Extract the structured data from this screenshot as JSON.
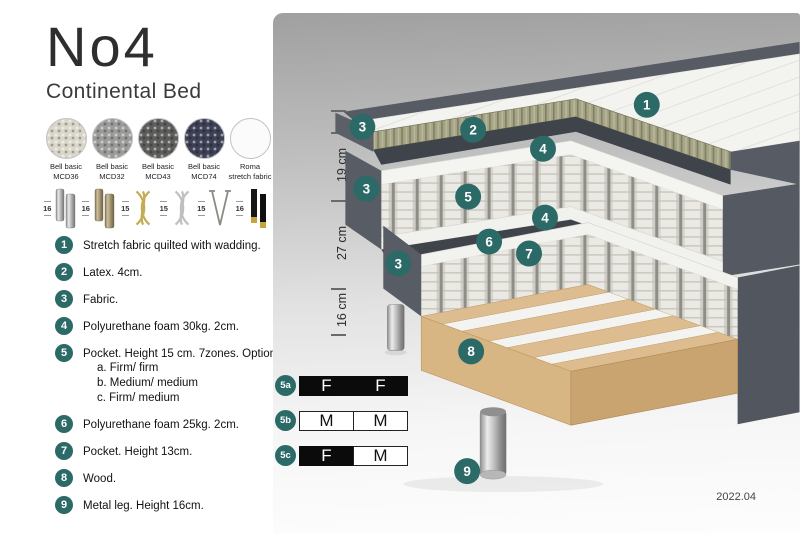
{
  "header": {
    "title": "No4",
    "subtitle": "Continental Bed"
  },
  "swatches": {
    "items": [
      {
        "line1": "Bell basic",
        "line2": "MCD36",
        "color": "#DAD6CA"
      },
      {
        "line1": "Bell basic",
        "line2": "MCD32",
        "color": "#9B9B99"
      },
      {
        "line1": "Bell basic",
        "line2": "MCD43",
        "color": "#5D5D5B"
      },
      {
        "line1": "Bell basic",
        "line2": "MCD74",
        "color": "#3E4156"
      },
      {
        "line1": "Roma",
        "line2": "stretch fabric",
        "color": "#FBFBFB"
      }
    ]
  },
  "legs": {
    "items": [
      {
        "size": "16",
        "name": "chrome-cylinder-leg"
      },
      {
        "size": "16",
        "name": "bronze-cylinder-leg"
      },
      {
        "size": "15",
        "name": "gold-twist-leg"
      },
      {
        "size": "15",
        "name": "silver-twist-leg"
      },
      {
        "size": "15",
        "name": "hairpin-leg"
      },
      {
        "size": "16",
        "name": "black-gold-leg"
      }
    ]
  },
  "features": [
    {
      "num": "1",
      "text": "Stretch fabric quilted with wadding."
    },
    {
      "num": "2",
      "text": "Latex. 4cm."
    },
    {
      "num": "3",
      "text": "Fabric."
    },
    {
      "num": "4",
      "text": "Polyurethane foam 30kg. 2cm."
    },
    {
      "num": "5",
      "text": "Pocket. Height 15 cm. 7zones. Option:",
      "options": [
        "a. Firm/ firm",
        "b. Medium/ medium",
        "c. Firm/ medium"
      ]
    },
    {
      "num": "6",
      "text": "Polyurethane foam 25kg. 2cm."
    },
    {
      "num": "7",
      "text": "Pocket. Height 13cm."
    },
    {
      "num": "8",
      "text": "Wood."
    },
    {
      "num": "9",
      "text": "Metal leg. Height 16cm."
    }
  ],
  "dimensions": [
    "6",
    "19 cm",
    "27 cm",
    "16 cm"
  ],
  "firmness": [
    {
      "label": "5a",
      "cells": [
        {
          "text": "F",
          "variant": "dark"
        },
        {
          "text": "F",
          "variant": "dark"
        }
      ]
    },
    {
      "label": "5b",
      "cells": [
        {
          "text": "M",
          "variant": "light"
        },
        {
          "text": "M",
          "variant": "light"
        }
      ]
    },
    {
      "label": "5c",
      "cells": [
        {
          "text": "F",
          "variant": "dark"
        },
        {
          "text": "M",
          "variant": "light"
        }
      ]
    }
  ],
  "callouts": {
    "c1": "1",
    "c2": "2",
    "c3a": "3",
    "c3b": "3",
    "c3c": "3",
    "c4a": "4",
    "c4b": "4",
    "c5": "5",
    "c6": "6",
    "c7": "7",
    "c8": "8",
    "c9": "9"
  },
  "footer": {
    "version": "2022.04"
  },
  "colors": {
    "accent_teal": "#2C6A68",
    "fabric_gray": "#565B64",
    "latex_olive": "#A5A486",
    "foam_white": "#F2F2EE",
    "wood_tan": "#DDBD8F",
    "leg_chrome": "#BDBDBD"
  }
}
